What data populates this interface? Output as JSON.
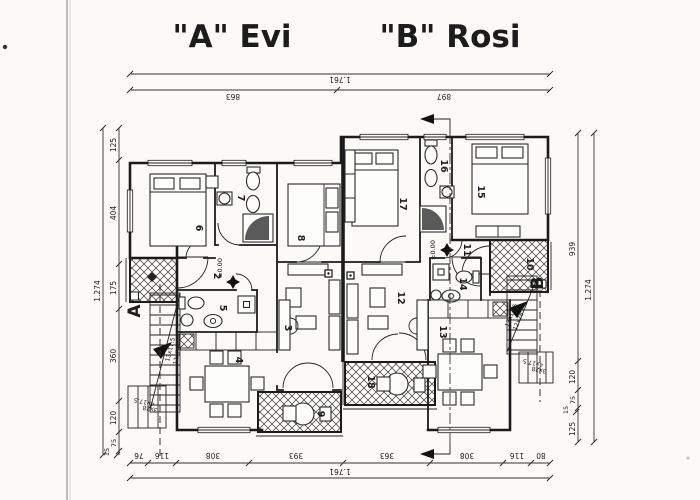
{
  "titles": {
    "unit_a": "\"A\" Evi",
    "unit_b": "\"B\" Rosi"
  },
  "dimensions": {
    "top": {
      "overall": "1.761",
      "unit_a_width": "863",
      "unit_b_width": "897"
    },
    "bottom": {
      "overall": "1.761",
      "segments": [
        "76",
        "116",
        "308",
        "393",
        "363",
        "308",
        "116",
        "80"
      ]
    },
    "left": {
      "overall": "1.274",
      "segments": [
        "125",
        "404",
        "175",
        "360",
        "120",
        "75",
        "15"
      ]
    },
    "right": {
      "overall": "1.274",
      "segments": [
        "939",
        "120",
        "75",
        "15",
        "125"
      ]
    }
  },
  "rooms": {
    "r2": "2",
    "r3": "3",
    "r4": "4",
    "r5": "5",
    "r6": "6",
    "r7": "7",
    "r8": "8",
    "r9": "9",
    "r10": "10",
    "r11": "11",
    "r12": "12",
    "r13": "13",
    "r14": "14",
    "r15": "15",
    "r16": "16",
    "r17": "17",
    "r18": "18"
  },
  "sections": {
    "a": "A",
    "b": "B"
  },
  "levels": {
    "unit_a": "±0.00",
    "unit_b": "±0.00"
  },
  "stairs": {
    "main_flight": {
      "risers": "13x17.5",
      "treads": "12x28"
    },
    "entry_steps": {
      "risers": "4x17.5",
      "treads": "3x28"
    }
  }
}
